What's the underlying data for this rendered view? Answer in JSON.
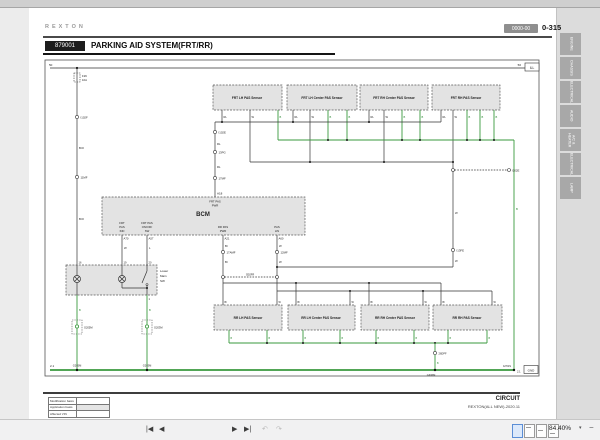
{
  "header": {
    "logo": "REXTON",
    "code_badge": "0000-00",
    "page_no": "0-315",
    "section_code": "879001",
    "title": "PARKING AID SYSTEM(FRT/RR)"
  },
  "sidebar": {
    "tabs": [
      {
        "label": "ENGINE"
      },
      {
        "label": "CHASSIS"
      },
      {
        "label": "ELECTRICAL"
      },
      {
        "label": "AUDIO"
      },
      {
        "label": "A/C & HEATER"
      },
      {
        "label": "ELECTRICAL"
      },
      {
        "label": "LAMP"
      }
    ]
  },
  "footer": {
    "table_rows": [
      {
        "label": "Modification basis"
      },
      {
        "label": "Application basis"
      },
      {
        "label": "Affected VIN"
      }
    ],
    "doc_type": "CIRCUIT",
    "doc_ref": "REXTON(ALL NEW)-2020.11"
  },
  "toolbar": {
    "page_value": "15 / 108",
    "zoom_value": "84.40%",
    "icons": {
      "first": "|◀",
      "prev": "◀",
      "next": "▶",
      "last": "▶|",
      "undo": "↶",
      "redo": "↷",
      "caret": "▾",
      "minus": "−"
    }
  },
  "diagram": {
    "refs": {
      "left": "50",
      "right": "50",
      "ill": "ILL",
      "gnd": "GND",
      "page_left": "2.1",
      "page_right": "2.1"
    },
    "fuse": {
      "name": "F26",
      "rating": "10A"
    },
    "wires": {
      "rl": "RL",
      "w": "W",
      "b": "B",
      "br": "Br",
      "bro": "BrO",
      "l": "L"
    },
    "connectors": {
      "i102f": "I102F",
      "c11mf": "11MF",
      "i102e": "I102E",
      "c13pg": "13PG",
      "c17mf": "17MF",
      "c17amf": "17AMF",
      "c12mf": "12MF",
      "i302fr": "I302FR",
      "i13fe": "I13FE",
      "c26dpf": "26DPF"
    },
    "grounds": {
      "g205m": "G205M",
      "g203m": "G203M",
      "g306m": "G306M",
      "g701s": "G701S"
    },
    "bcm": {
      "name": "BCM",
      "pin_top": "A18",
      "pin_ind": "A70",
      "pin_sw": "A57",
      "pin_rr": "A21",
      "pin_lin": "A60",
      "lbl_top1": "FRT PAS",
      "lbl_top2": "PWR",
      "lbl_ind1": "FRT",
      "lbl_ind2": "PAS",
      "lbl_ind3": "IND",
      "lbl_sw1": "FRT PAS",
      "lbl_sw2": "ON/OFF",
      "lbl_sw3": "SW",
      "lbl_rr1": "RR PAS",
      "lbl_rr2": "PWR",
      "lbl_lin1": "PAS",
      "lbl_lin2": "LIN"
    },
    "switch_box": {
      "l1": "Lower",
      "l2": "Main",
      "l3": "SW",
      "pin_a": "16",
      "pin_b": "19",
      "pin_c": "20",
      "pin_d": "1"
    },
    "frt_sensors": [
      {
        "name": "FRT LH PAS Sensor"
      },
      {
        "name": "FRT LH Center PAS Sensor"
      },
      {
        "name": "FRT RH Center PAS Sensor"
      },
      {
        "name": "FRT RH PAS Sensor"
      }
    ],
    "rr_sensors": [
      {
        "name": "RR LH PAS Sensor"
      },
      {
        "name": "RR LH Center PAS Sensor"
      },
      {
        "name": "RR RH Center PAS Sensor"
      },
      {
        "name": "RR RH PAS Sensor"
      }
    ]
  }
}
